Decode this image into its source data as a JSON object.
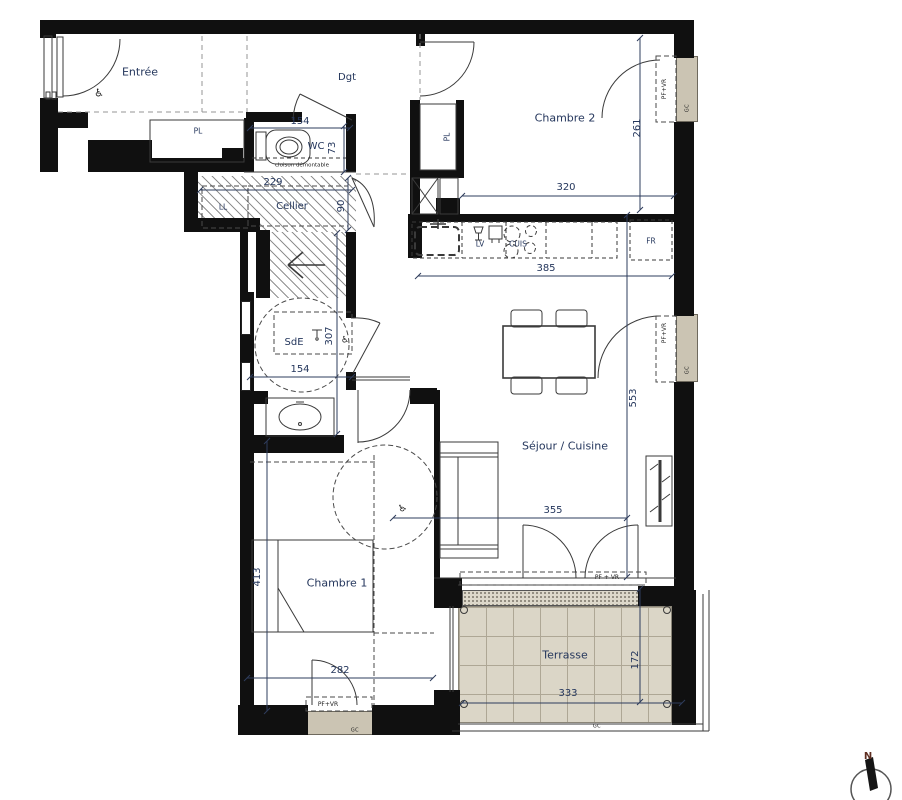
{
  "rooms": {
    "entree": "Entrée",
    "dgt": "Dgt",
    "wc": "WC",
    "cellier": "Cellier",
    "sde": "SdE",
    "chambre2": "Chambre 2",
    "sejour": "Séjour / Cuisine",
    "chambre1": "Chambre 1",
    "terrasse": "Terrasse"
  },
  "fixtures": {
    "pl_entree": "PL",
    "pl_chambre2": "PL",
    "ll": "LL",
    "lv": "LV",
    "cuis": "CUIS",
    "fr": "FR"
  },
  "annotations": {
    "cloison": "cloison démontable",
    "pfvr": "PF+VR",
    "pfvr_spaced": "PF + VR",
    "gc": "GC",
    "north": "N",
    "wheelchair": "♿"
  },
  "dimensions": {
    "wc_width": "154",
    "wc_depth": "73",
    "cellier_width": "229",
    "cellier_depth": "90",
    "chambre2_width": "320",
    "chambre2_depth": "261",
    "cuisine_width": "385",
    "sejour_depth": "553",
    "sejour_width": "355",
    "chambre1_depth": "413",
    "chambre1_width": "282",
    "sde_depth": "307",
    "sde_width": "154",
    "terrasse_width": "333",
    "terrasse_depth": "172"
  },
  "colors": {
    "wall": "#101010",
    "sill": "#cbc4b3",
    "terrace_tile": "#dbd6c7",
    "label": "#24365c"
  }
}
